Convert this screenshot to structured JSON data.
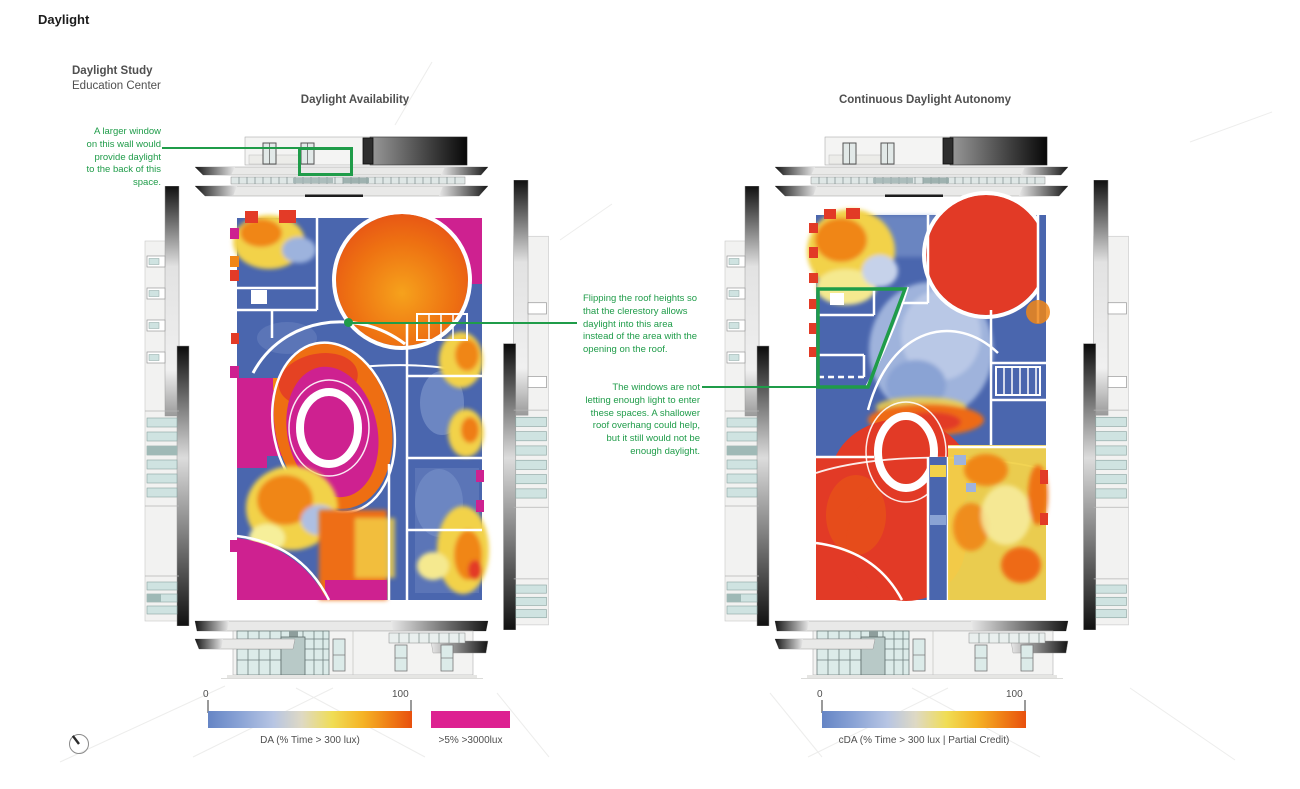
{
  "page": {
    "title": "Daylight"
  },
  "header": {
    "study_title": "Daylight Study",
    "study_subtitle": "Education Center"
  },
  "panels": {
    "left": {
      "title": "Daylight Availability"
    },
    "right": {
      "title": "Continuous Daylight Autonomy"
    }
  },
  "annotations": {
    "window_note": "A larger window\non this wall would\nprovide daylight\nto the back of this\nspace.",
    "roof_note": "Flipping the roof heights so\nthat the clerestory allows\ndaylight into this area\ninstead of the area with the\nopening on the roof.",
    "overhang_note": "The windows are not\nletting enough light to enter\nthese spaces. A shallower\nroof overhang could help,\nbut it still would not be\nenough daylight."
  },
  "legends": {
    "da": {
      "min": "0",
      "max": "100",
      "caption": "DA (% Time > 300 lux)"
    },
    "threshold": {
      "caption": ">5% >3000lux"
    },
    "cda": {
      "min": "0",
      "max": "100",
      "caption": "cDA (% Time > 300 lux | Partial Credit)"
    }
  },
  "colors": {
    "accent_green": "#1f9c49",
    "heat_blue": "#4a66ae",
    "heat_light_blue": "#9fb3dc",
    "heat_yellow": "#f2d24a",
    "heat_orange": "#ee6e12",
    "heat_red": "#e23a26",
    "heat_magenta": "#ce2190",
    "legend_magenta": "#dd2191"
  },
  "icons": {
    "compass": "north-arrow-icon"
  }
}
